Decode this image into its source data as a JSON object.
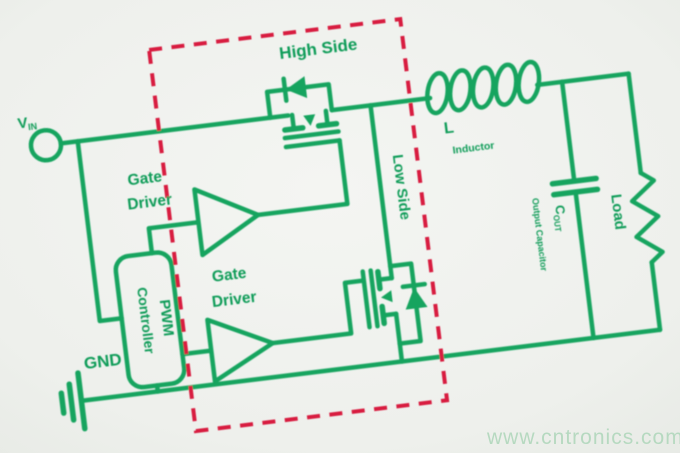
{
  "colors": {
    "wire_green": "#14a45e",
    "label_green": "#109c58",
    "boundary_red": "#d81e40",
    "background": "#eff1ed",
    "watermark_green": "#b6d9c0"
  },
  "watermark": {
    "text": "www.cntronics.com",
    "color": "#b6d9c0"
  },
  "schematic": {
    "type": "synchronous buck converter power stage",
    "input": {
      "label": "V",
      "label_sub": "IN"
    },
    "ground": {
      "label": "GND"
    },
    "controller": {
      "line1": "PWM",
      "line2": "Controller"
    },
    "gate_driver_high": {
      "line1": "Gate",
      "line2": "Driver"
    },
    "gate_driver_low": {
      "line1": "Gate",
      "line2": "Driver"
    },
    "switch_high": {
      "label": "High Side"
    },
    "switch_low": {
      "label": "Low Side"
    },
    "inductor": {
      "ref": "L",
      "name": "Inductor"
    },
    "output_capacitor": {
      "ref": "C",
      "ref_sub": "OUT",
      "name": "Output Capacitor"
    },
    "load": {
      "label": "Load"
    }
  }
}
